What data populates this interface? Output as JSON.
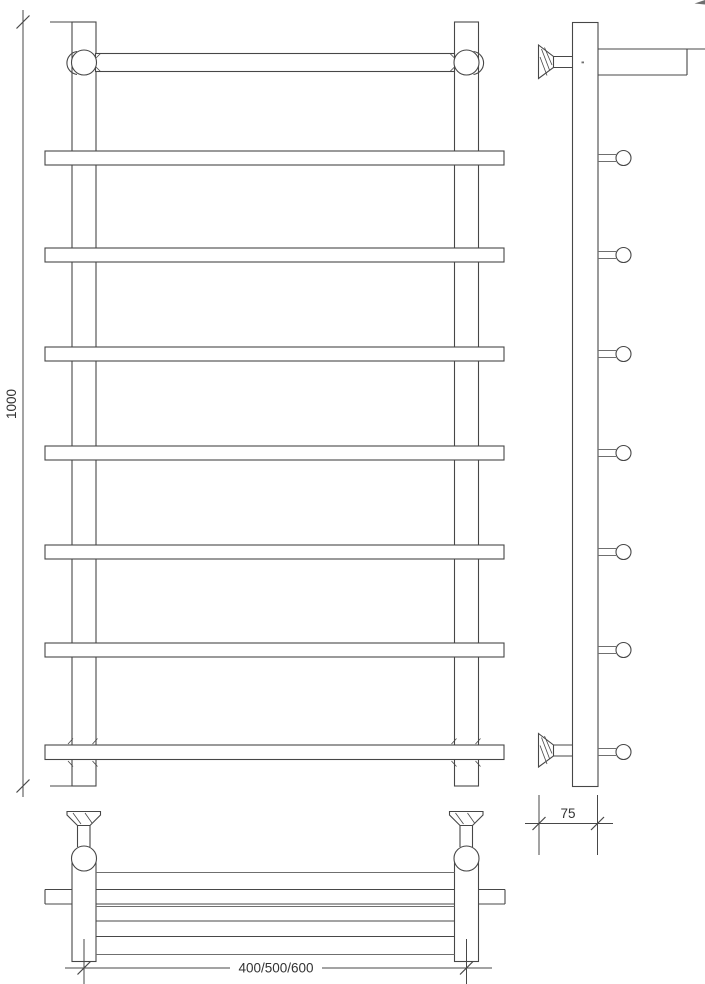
{
  "drawing_labels": {
    "height_mm": "1000",
    "wall_offset_mm": "75",
    "width_options_mm": "400/500/600"
  },
  "style": {
    "line-color": "#474747",
    "light-line-color": "#6f6f6f",
    "text-color": "#333333",
    "background": "#ffffff"
  }
}
